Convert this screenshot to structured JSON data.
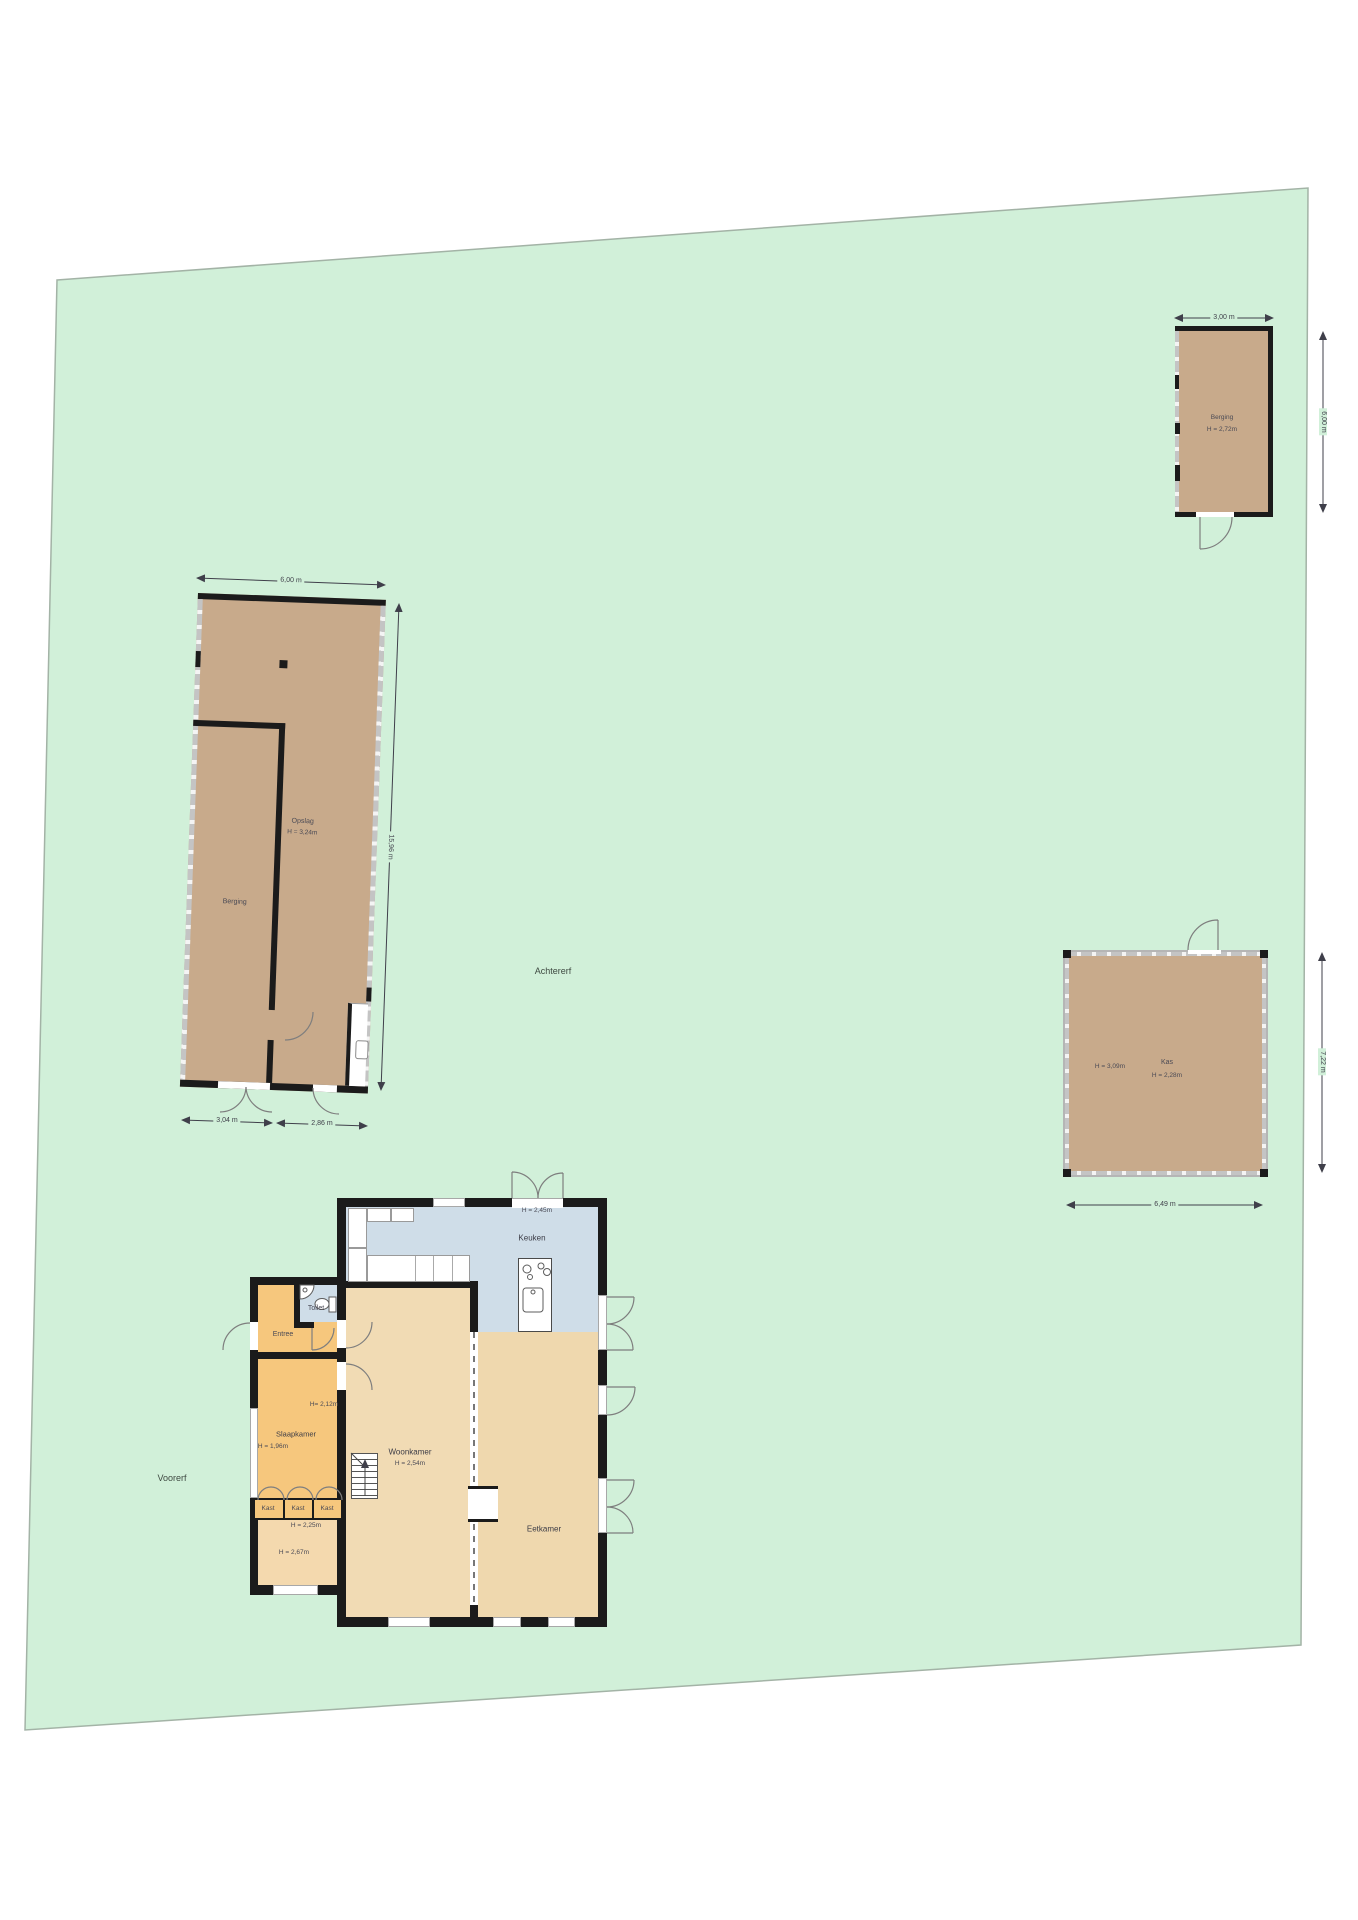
{
  "colors": {
    "parcel_green": "#d1f0d9",
    "parcel_border": "#a3b3a6",
    "shed_tan": "#c8aa8b",
    "floor_tan": "#f1dbb4",
    "floor_orange": "#f6c77d",
    "floor_blue": "#cfdde8",
    "wall_black": "#1b1b1b"
  },
  "site": {
    "back_yard_label": "Achtererf",
    "front_yard_label": "Voorerf"
  },
  "storage_shed": {
    "label": "Berging",
    "height_label": "H = 2,72m",
    "top_dim": "3,00 m",
    "side_dim": "6,00 m"
  },
  "barn": {
    "storage_label": "Opslag",
    "storage_height_label": "H = 3,24m",
    "shed_label": "Berging",
    "top_dim": "6,00 m",
    "side_dim": "15,96 m",
    "bottom_left_dim": "3,04 m",
    "bottom_right_dim": "2,86 m"
  },
  "greenhouse": {
    "label": "Kas",
    "height_label": "H = 2,28m",
    "height_label_left": "H = 3,09m",
    "side_dim": "7,22 m",
    "bottom_dim": "6,49 m"
  },
  "house": {
    "kitchen": {
      "label": "Keuken",
      "height_label": "H = 2,45m"
    },
    "toilet_label": "Toilet",
    "entry_label": "Entree",
    "bedroom": {
      "label": "Slaapkamer",
      "height_label": "H = 1,96m",
      "height_label2": "H= 2,12m"
    },
    "living_room": {
      "label": "Woonkamer",
      "height_label": "H = 2,54m"
    },
    "dining_room_label": "Eetkamer",
    "closets": [
      "Kast",
      "Kast",
      "Kast"
    ],
    "hall": {
      "height_label_top": "H = 2,25m",
      "height_label": "H = 2,67m"
    }
  }
}
